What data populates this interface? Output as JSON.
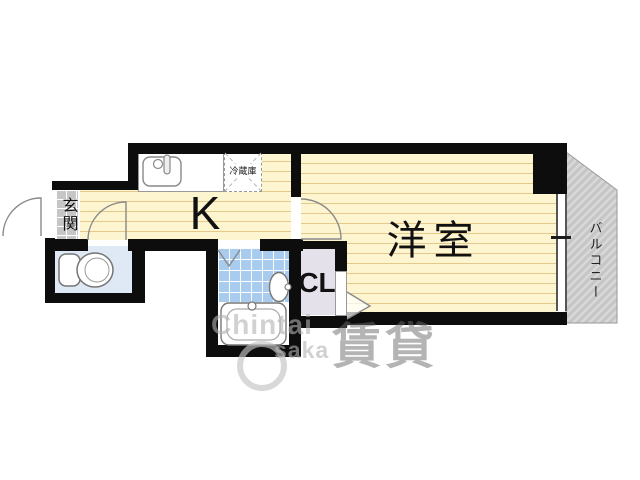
{
  "floorplan": {
    "labels": {
      "kitchen": "K",
      "western_room": "洋室",
      "closet": "CL",
      "entrance": "玄関",
      "balcony": "バルコニー",
      "refrigerator": "冷蔵庫"
    },
    "colors": {
      "wall": "#0d0d0d",
      "flooring_bg": "#fdf4d0",
      "flooring_stripe": "#e5c98c",
      "toilet_room": "#dfe9f6",
      "bath_tiles": "#a9cbee",
      "closet_floor": "#e5e1eb",
      "entrance_tile": "#c6c6c6",
      "balcony_deck": "#c6c6c6"
    }
  },
  "watermark": {
    "line1": "Chintai",
    "line2": "saka",
    "cjk": "賃貸"
  }
}
